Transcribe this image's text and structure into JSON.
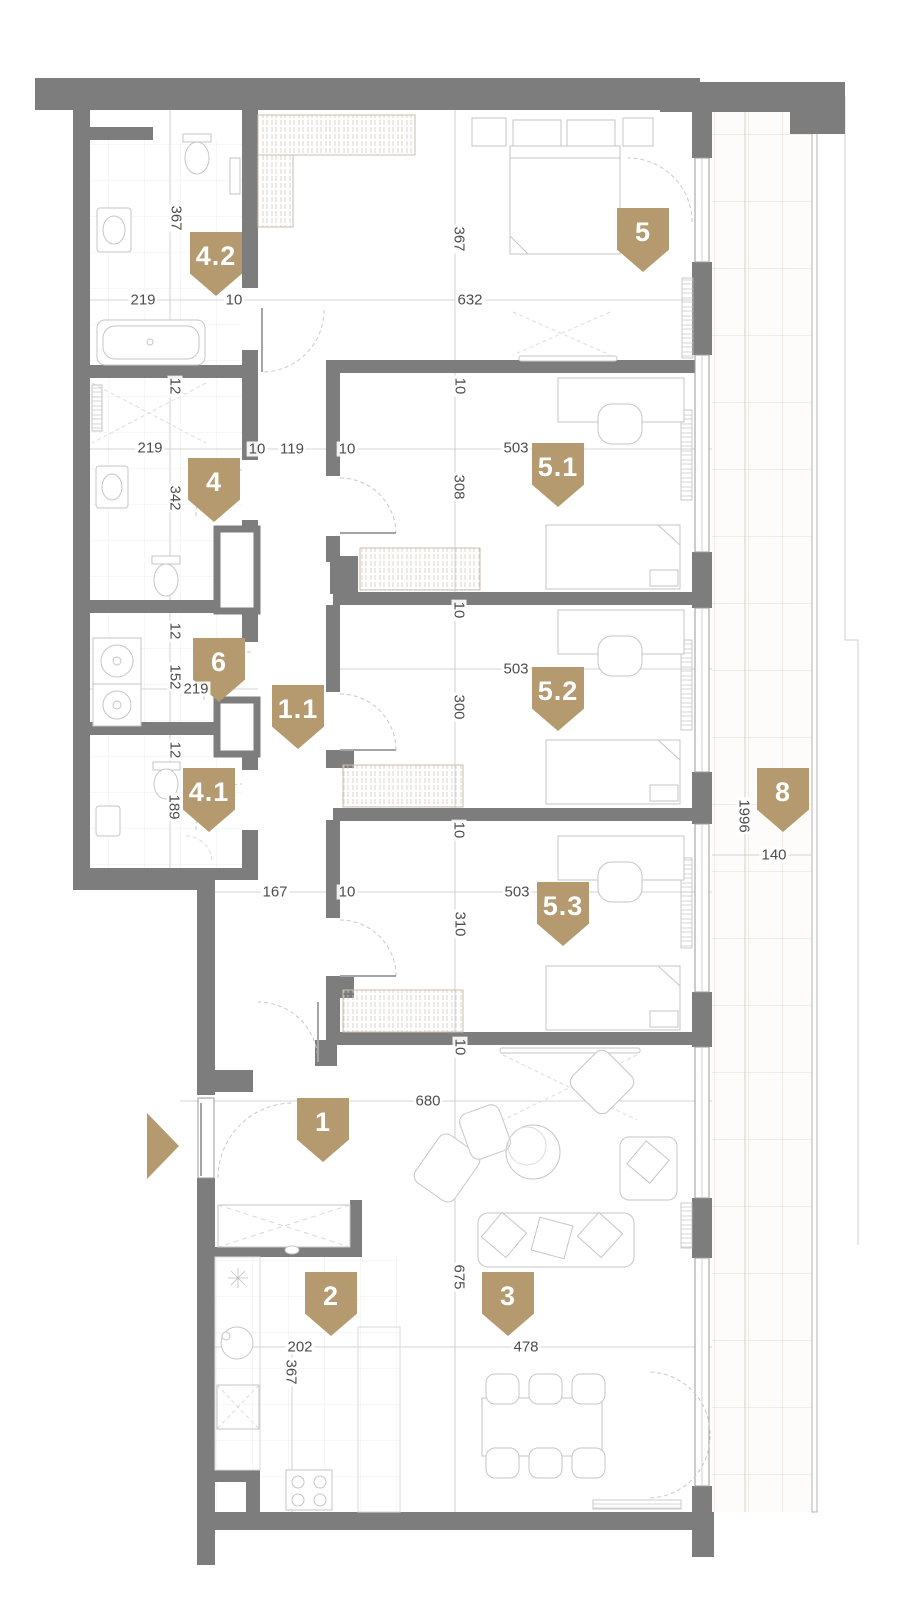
{
  "plan": {
    "type": "apartment-floor-plan",
    "colors": {
      "marker": "#b49a6e",
      "wall": "#7d7d7d",
      "dim_text": "#4d4d4d"
    },
    "entrance": {
      "icon": "entrance-arrow",
      "direction": "right"
    },
    "markers": [
      {
        "id": "4.2",
        "label": "4.2",
        "x": 190,
        "y": 232
      },
      {
        "id": "5",
        "label": "5",
        "x": 617,
        "y": 208
      },
      {
        "id": "4",
        "label": "4",
        "x": 188,
        "y": 458
      },
      {
        "id": "5.1",
        "label": "5.1",
        "x": 532,
        "y": 443
      },
      {
        "id": "6",
        "label": "6",
        "x": 193,
        "y": 638
      },
      {
        "id": "1.1",
        "label": "1.1",
        "x": 272,
        "y": 685
      },
      {
        "id": "5.2",
        "label": "5.2",
        "x": 532,
        "y": 667
      },
      {
        "id": "4.1",
        "label": "4.1",
        "x": 183,
        "y": 768
      },
      {
        "id": "8",
        "label": "8",
        "x": 757,
        "y": 768
      },
      {
        "id": "5.3",
        "label": "5.3",
        "x": 537,
        "y": 882
      },
      {
        "id": "1",
        "label": "1",
        "x": 297,
        "y": 1098
      },
      {
        "id": "2",
        "label": "2",
        "x": 305,
        "y": 1272
      },
      {
        "id": "3",
        "label": "3",
        "x": 482,
        "y": 1272
      }
    ],
    "dimensions": [
      {
        "text": "367",
        "x": 176,
        "y": 218,
        "vertical": true
      },
      {
        "text": "219",
        "x": 143,
        "y": 300,
        "vertical": false
      },
      {
        "text": "10",
        "x": 234,
        "y": 300,
        "vertical": false
      },
      {
        "text": "367",
        "x": 459,
        "y": 239,
        "vertical": true
      },
      {
        "text": "632",
        "x": 470,
        "y": 300,
        "vertical": false
      },
      {
        "text": "12",
        "x": 175,
        "y": 386,
        "vertical": true
      },
      {
        "text": "219",
        "x": 150,
        "y": 448,
        "vertical": false
      },
      {
        "text": "10",
        "x": 257,
        "y": 449,
        "vertical": false
      },
      {
        "text": "119",
        "x": 292,
        "y": 449,
        "vertical": false
      },
      {
        "text": "10",
        "x": 347,
        "y": 449,
        "vertical": false
      },
      {
        "text": "342",
        "x": 175,
        "y": 498,
        "vertical": true
      },
      {
        "text": "10",
        "x": 460,
        "y": 386,
        "vertical": true
      },
      {
        "text": "503",
        "x": 516,
        "y": 448,
        "vertical": false
      },
      {
        "text": "308",
        "x": 459,
        "y": 487,
        "vertical": true
      },
      {
        "text": "10",
        "x": 459,
        "y": 610,
        "vertical": true
      },
      {
        "text": "12",
        "x": 175,
        "y": 631,
        "vertical": true
      },
      {
        "text": "152",
        "x": 175,
        "y": 677,
        "vertical": true
      },
      {
        "text": "219",
        "x": 196,
        "y": 689,
        "vertical": false
      },
      {
        "text": "503",
        "x": 516,
        "y": 669,
        "vertical": false
      },
      {
        "text": "300",
        "x": 459,
        "y": 707,
        "vertical": true
      },
      {
        "text": "12",
        "x": 175,
        "y": 750,
        "vertical": true
      },
      {
        "text": "189",
        "x": 174,
        "y": 807,
        "vertical": true
      },
      {
        "text": "10",
        "x": 459,
        "y": 830,
        "vertical": true
      },
      {
        "text": "1996",
        "x": 744,
        "y": 816,
        "vertical": true
      },
      {
        "text": "140",
        "x": 774,
        "y": 855,
        "vertical": false
      },
      {
        "text": "167",
        "x": 275,
        "y": 892,
        "vertical": false
      },
      {
        "text": "10",
        "x": 347,
        "y": 892,
        "vertical": false
      },
      {
        "text": "503",
        "x": 517,
        "y": 892,
        "vertical": false
      },
      {
        "text": "310",
        "x": 460,
        "y": 924,
        "vertical": true
      },
      {
        "text": "10",
        "x": 460,
        "y": 1047,
        "vertical": true
      },
      {
        "text": "680",
        "x": 428,
        "y": 1101,
        "vertical": false
      },
      {
        "text": "675",
        "x": 459,
        "y": 1277,
        "vertical": true
      },
      {
        "text": "202",
        "x": 300,
        "y": 1347,
        "vertical": false
      },
      {
        "text": "367",
        "x": 291,
        "y": 1372,
        "vertical": true
      },
      {
        "text": "478",
        "x": 526,
        "y": 1347,
        "vertical": false
      }
    ]
  }
}
